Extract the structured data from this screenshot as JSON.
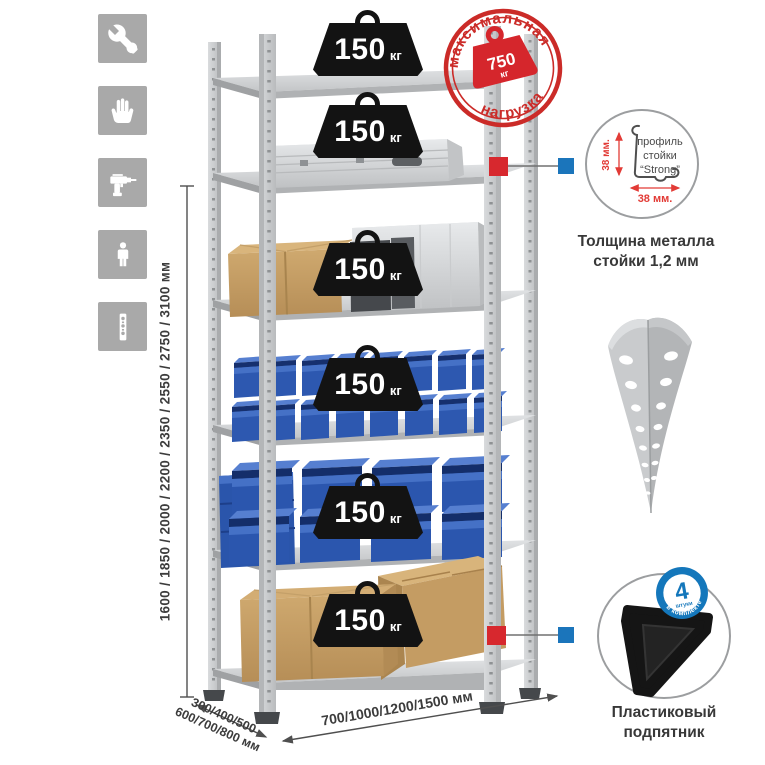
{
  "left_toolbar": {
    "icons": [
      {
        "label": "wrench"
      },
      {
        "label": "gloves"
      },
      {
        "label": "drill"
      },
      {
        "label": "person-height"
      },
      {
        "label": "post-profile"
      }
    ]
  },
  "height_dimension": {
    "text": "1600 / 1850 / 2000 / 2200 / 2350 / 2550 / 2750 / 3100 мм"
  },
  "depth_dimension": {
    "line1": "300/400/500",
    "line2": "600/700/800 мм"
  },
  "width_dimension": {
    "text": "700/1000/1200/1500 мм"
  },
  "shelf_loads": [
    {
      "value": "150",
      "unit": "кг"
    },
    {
      "value": "150",
      "unit": "кг"
    },
    {
      "value": "150",
      "unit": "кг"
    },
    {
      "value": "150",
      "unit": "кг"
    },
    {
      "value": "150",
      "unit": "кг"
    },
    {
      "value": "150",
      "unit": "кг"
    }
  ],
  "max_load_stamp": {
    "arc_top": "максимальная",
    "arc_bottom": "нагрузка",
    "value": "750",
    "unit": "кг"
  },
  "profile_detail": {
    "label_line1": "профиль",
    "label_line2": "стойки",
    "label_line3": "“Strong”",
    "vertical_dim": "38 мм.",
    "horizontal_dim": "38 мм.",
    "caption_line1": "Толщина металла",
    "caption_line2": "стойки 1,2 мм"
  },
  "foot_detail": {
    "badge_count": "4",
    "badge_small": "штуки",
    "badge_arc": "в комплекте",
    "caption_line1": "Пластиковый",
    "caption_line2": "подпятник"
  },
  "colors": {
    "accent_red": "#d7282e",
    "accent_blue": "#1b75bb",
    "stamp_red": "#cb2b28",
    "bin_blue": "#2d58b0",
    "icon_bg": "#a9a9a9"
  }
}
